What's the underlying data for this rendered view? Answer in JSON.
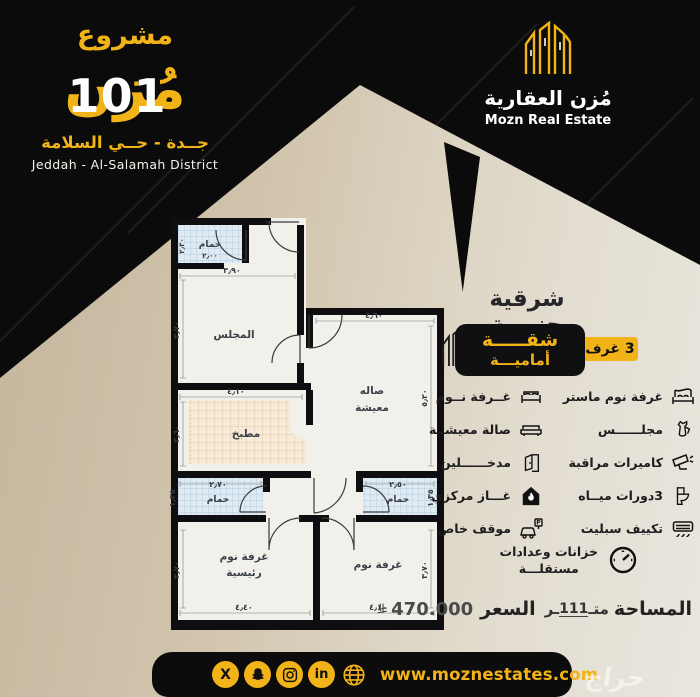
{
  "header": {
    "project_label": "مشروع",
    "project_name": "مُزن",
    "project_number": "101",
    "location_ar": "جــدة - حــي السلامة",
    "location_en": "Jeddah - Al-Salamah District"
  },
  "brand": {
    "name_ar": "مُزن العقارية",
    "name_en": "Mozn Real Estate",
    "logo_icon": "buildings-icon"
  },
  "panel": {
    "orientation": "شرقية جنوبية",
    "badge_line1": "شقـــــة",
    "badge_line2": "أماميـــة",
    "rooms_badge": "3 غرف"
  },
  "features": {
    "right": [
      {
        "label": "غرفة نوم ماستر",
        "icon": "master-bed-icon"
      },
      {
        "label": "مجلــــــس",
        "icon": "dallah-coffee-pot-icon"
      },
      {
        "label": "كاميرات مراقبة",
        "icon": "cctv-camera-icon"
      },
      {
        "label": "3دورات ميــاه",
        "icon": "toilet-icon"
      },
      {
        "label": "تكييف سبليت",
        "icon": "split-ac-icon"
      }
    ],
    "left": [
      {
        "label": "غــرفة نــوم",
        "icon": "bed-icon"
      },
      {
        "label": "صالة معيشــة",
        "icon": "sofa-icon"
      },
      {
        "label": "مدخــــــلين",
        "icon": "door-icon"
      },
      {
        "label": "غـــاز مركزي",
        "icon": "gas-flame-house-icon"
      },
      {
        "label": "موقف خاص",
        "icon": "car-parking-icon"
      }
    ],
    "bottom": {
      "line1": "خزانات وعدادات",
      "line2": "مستقلـــة",
      "icon": "meter-gauge-icon"
    }
  },
  "plan": {
    "rooms": {
      "bath_top": "حمام",
      "majlis": "المجلس",
      "living1": "صاله",
      "living2": "معيشة",
      "kitchen": "مطبخ",
      "bath_left": "حمام",
      "bath_right": "حمام",
      "master1": "غرفة نوم",
      "master2": "رئيسية",
      "bedroom": "غرفة نوم"
    },
    "dims": {
      "bath_top_v": "٢٫٣٠",
      "bath_top_h": "٢٫٠٠",
      "majlis_w": "٣٫٩٠",
      "majlis_h": "٣٫٧٠",
      "living_w": "٤٫٦٠",
      "living_h": "٥٫٢٠",
      "kitchen_w": "٤٫١٠",
      "kitchen_h": "٢٫٦٠",
      "wc_left_w": "٢٫٧٠",
      "wc_left_h": "١٫٣٥",
      "wc_right_w": "٢٫٥٠",
      "wc_right_h": "١٫٣٥",
      "master_w": "٤٫٤٠",
      "master_h": "٣٫٧٠",
      "bed_w": "٤٫١٠",
      "bed_h": "٣٫٧٠"
    }
  },
  "footer": {
    "area_label": "المساحة",
    "area_pre": "متـ",
    "area_num": "111",
    "area_post": "ـر",
    "price_label": "السعر",
    "price_value": "470.000",
    "currency_icon": "saudi-riyal-symbol",
    "website": "www.moznestates.com",
    "social_icons": [
      "x-icon",
      "snapchat-icon",
      "instagram-icon",
      "linkedin-icon",
      "globe-icon"
    ]
  },
  "watermark": "حراج",
  "colors": {
    "gold": "#f2b319",
    "black": "#0b0b0c",
    "beige": "#d2c5ad",
    "plan_bg": "#f2f0ea"
  }
}
